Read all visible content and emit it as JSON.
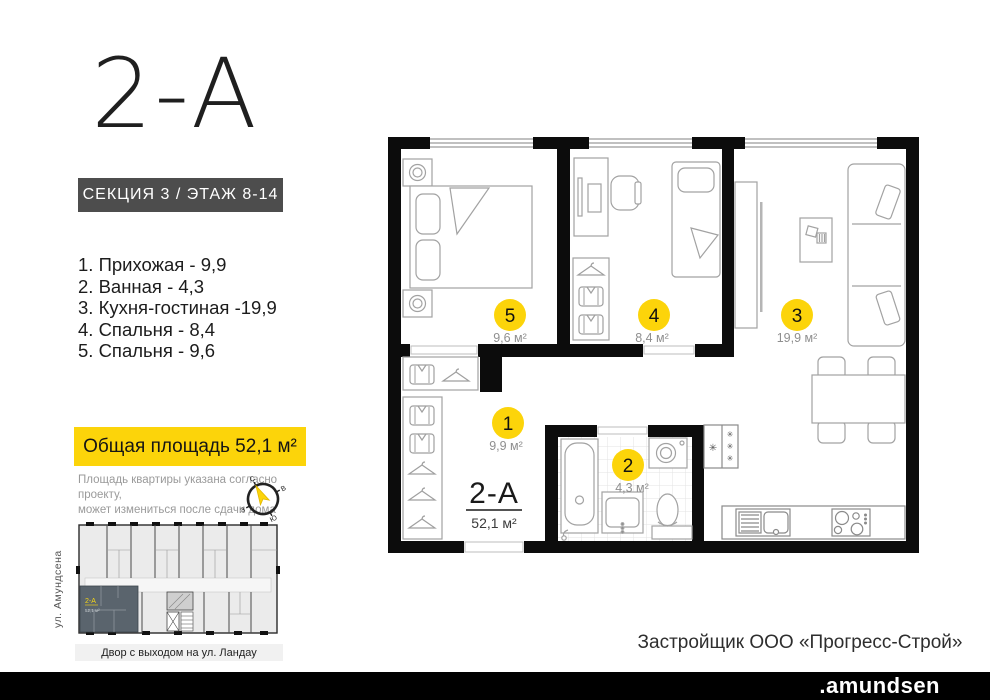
{
  "palette": {
    "accent_yellow": "#fcd40a",
    "wall_black": "#0c0c0c",
    "badge_gray": "#4d4d4d",
    "mini_highlight": "#5a646d"
  },
  "header": {
    "title": "2-А",
    "section_badge": "СЕКЦИЯ 3 / ЭТАЖ 8-14"
  },
  "rooms": [
    {
      "num": "1",
      "name": "Прихожая",
      "area": "9,9",
      "list_label": "1. Прихожая - 9,9",
      "area_label": "9,9 м²"
    },
    {
      "num": "2",
      "name": "Ванная",
      "area": "4,3",
      "list_label": "2. Ванная - 4,3",
      "area_label": "4,3 м²"
    },
    {
      "num": "3",
      "name": "Кухня-гостиная",
      "area": "19,9",
      "list_label": "3. Кухня-гостиная -19,9",
      "area_label": "19,9 м²"
    },
    {
      "num": "4",
      "name": "Спальня",
      "area": "8,4",
      "list_label": "4. Спальня - 8,4",
      "area_label": "8,4 м²"
    },
    {
      "num": "5",
      "name": "Спальня",
      "area": "9,6",
      "list_label": "5. Спальня - 9,6",
      "area_label": "9,6 м²"
    }
  ],
  "total_area": {
    "badge_label": "Общая площадь 52,1 м²"
  },
  "disclaimer": {
    "line1": "Площадь квартиры указана согласно проекту,",
    "line2": "может измениться после сдачи дома"
  },
  "compass": {
    "n": "С",
    "e": "В",
    "s": "Ю",
    "w": "З"
  },
  "plan": {
    "apartment_label": "2-А",
    "apartment_area": "52,1 м²"
  },
  "mini_plan": {
    "apartment_label": "2-А",
    "apartment_area": "52,1 м²",
    "street_left": "ул. Амундсена",
    "street_bottom": "Двор с выходом на ул. Ландау"
  },
  "footer": {
    "developer": "Застройщик ООО «Прогресс-Строй»",
    "brand": ".amundsen"
  }
}
